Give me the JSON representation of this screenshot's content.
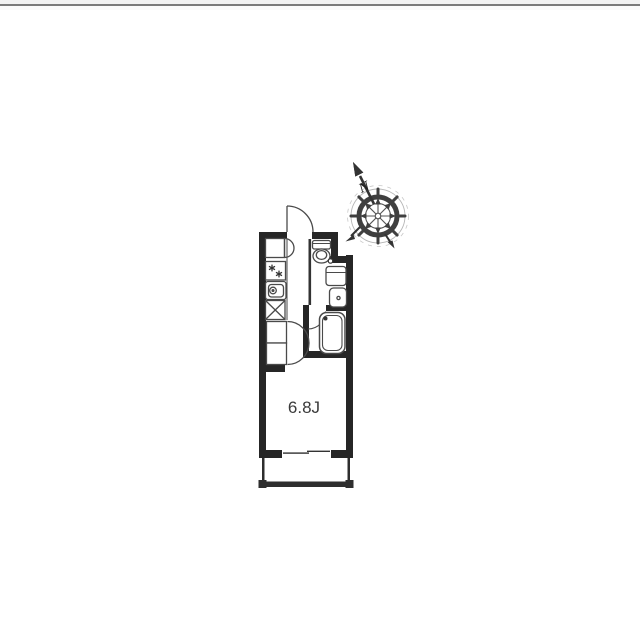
{
  "page": {
    "background": "#ffffff",
    "divider_color": "#7a7a7a"
  },
  "floorplan": {
    "room": {
      "label": "6.8J"
    },
    "compass": {
      "north_label": "N"
    },
    "colors": {
      "wall": "#262626",
      "fixture_line": "#4a4a4a",
      "compass": "#3f3f3f",
      "label_text": "#3a3a3a"
    },
    "icons": [
      "entrance-door-icon",
      "shoe-cabinet-icon",
      "gas-stove-icon",
      "kitchen-sink-icon",
      "washer-space-icon",
      "toilet-icon",
      "door-knob-icon",
      "washbasin-icon",
      "washing-machine-icon",
      "bath-door-icon",
      "bathtub-icon",
      "closet-icon",
      "sliding-window-icon",
      "balcony",
      "compass-icon"
    ]
  }
}
